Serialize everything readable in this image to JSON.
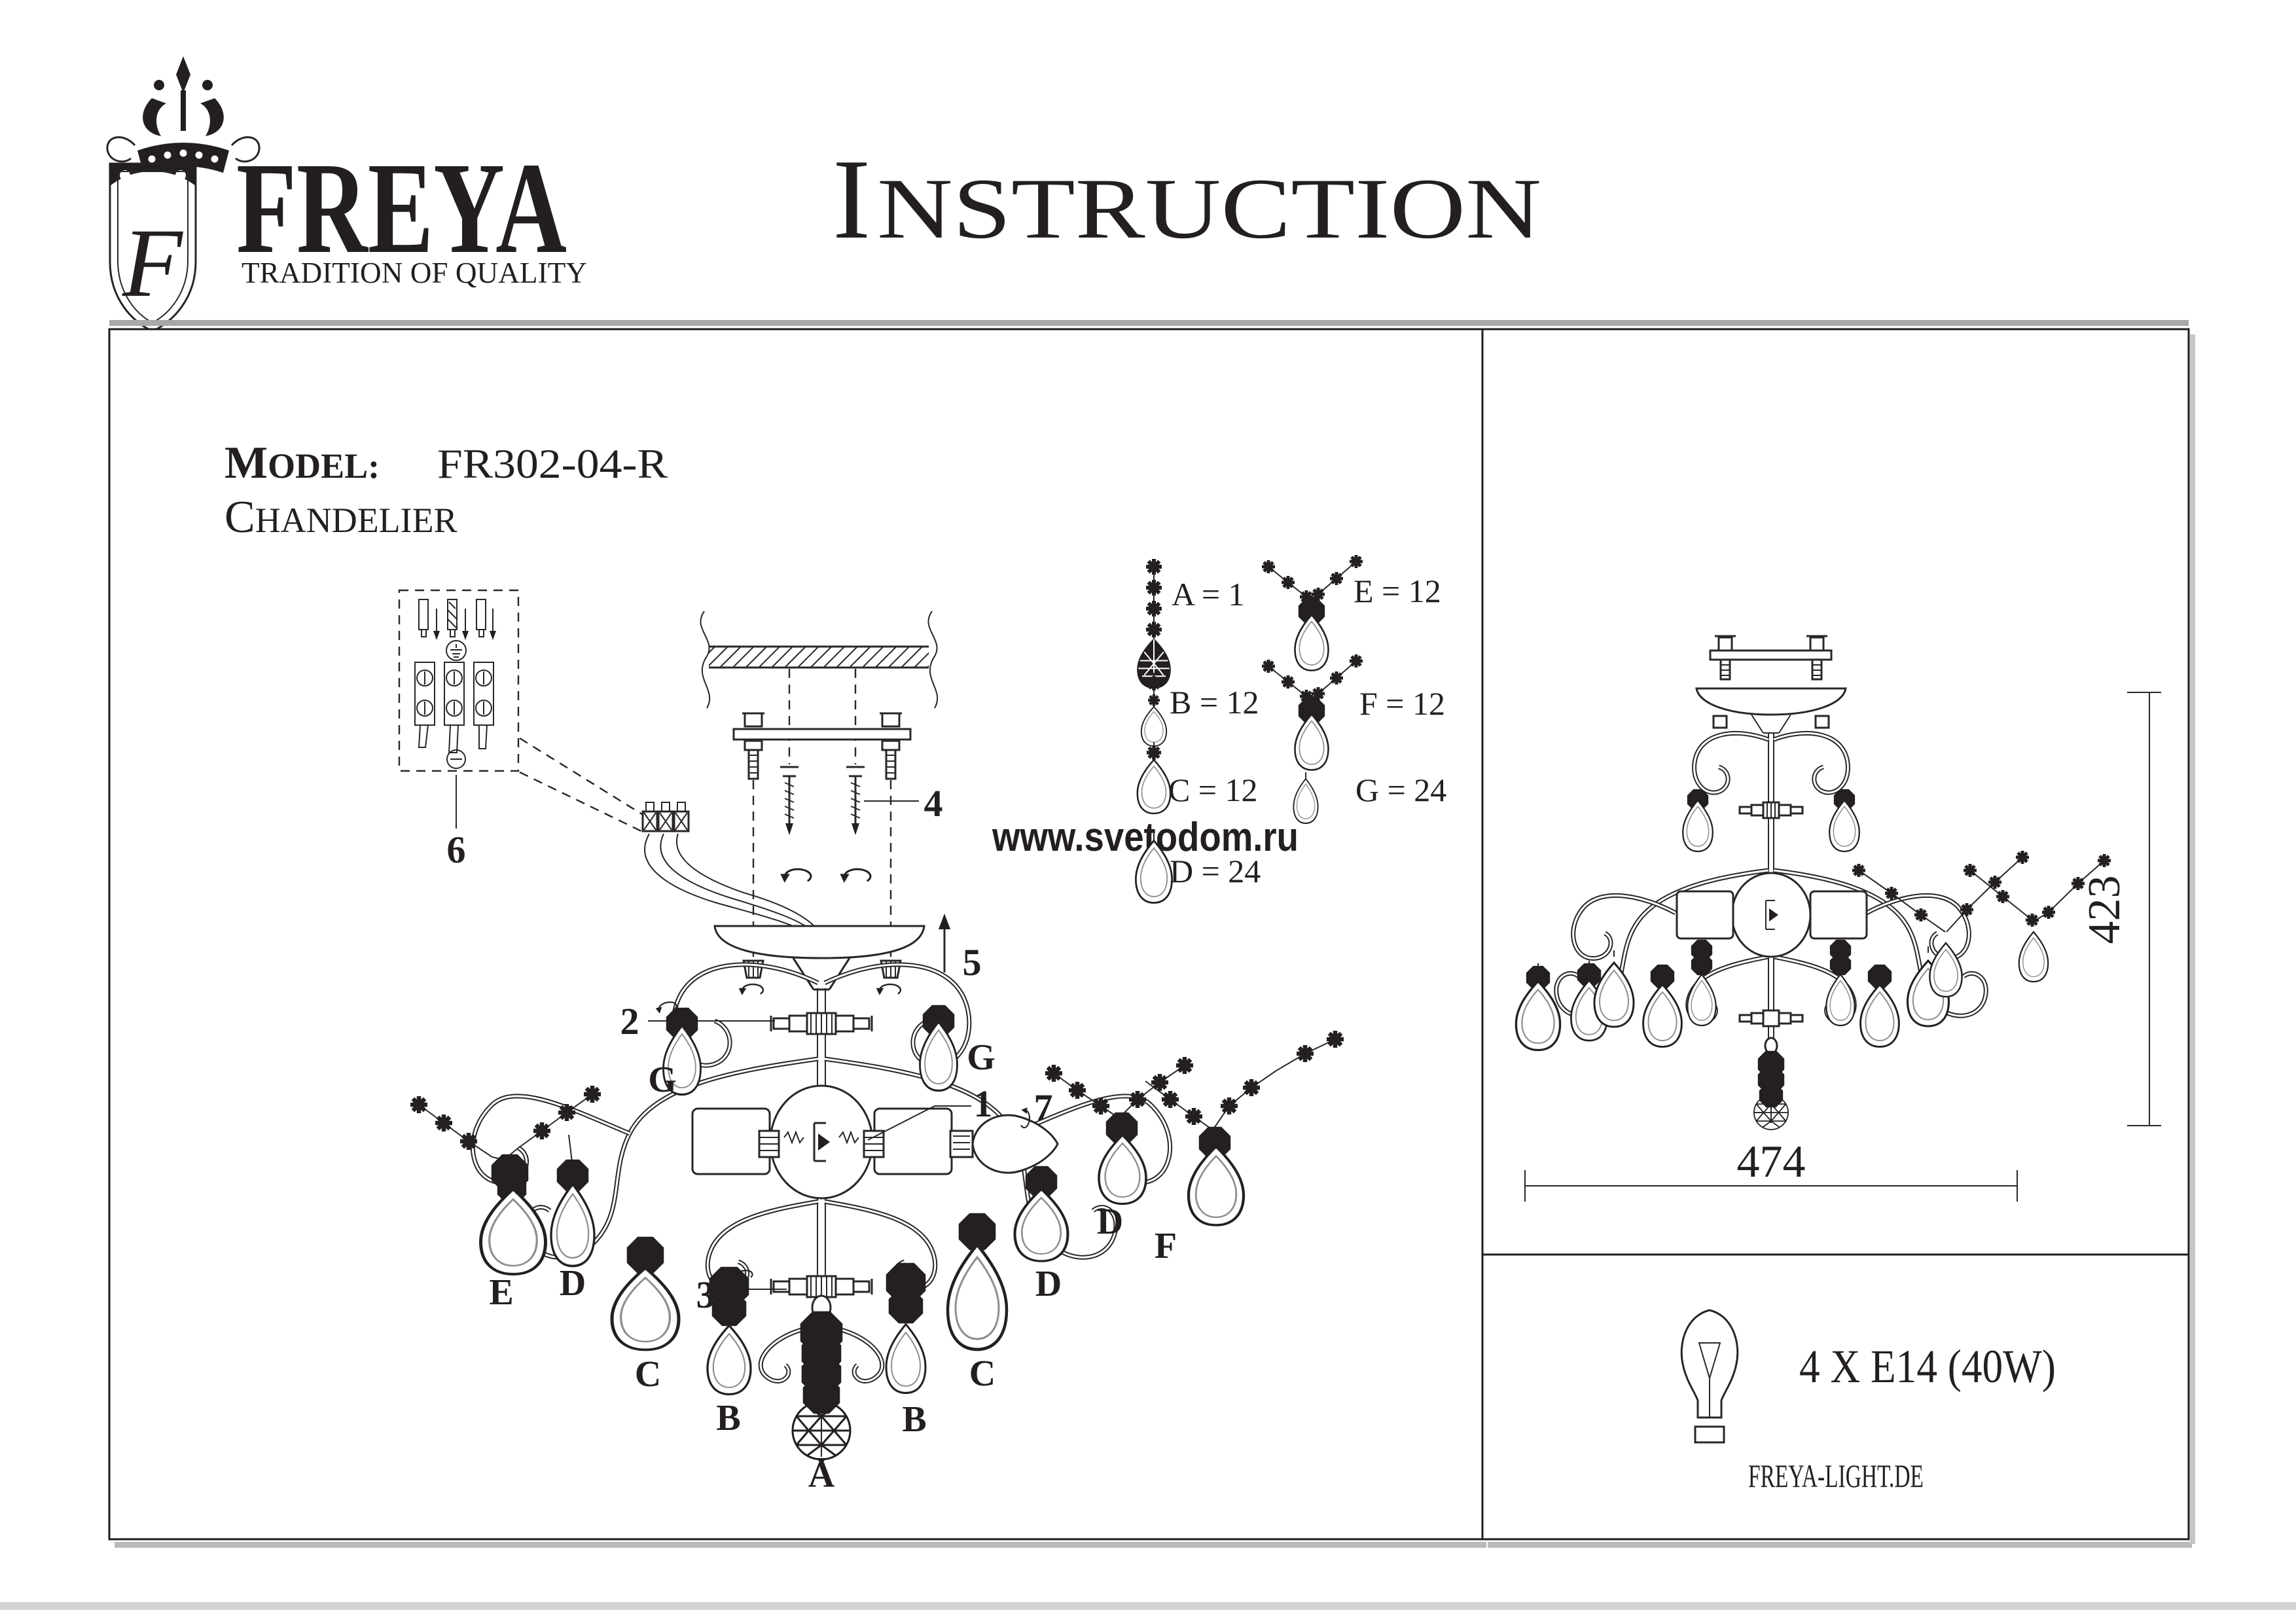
{
  "header": {
    "logo": {
      "monogram": "F",
      "brand": "FREYA",
      "tagline": "TRADITION OF QUALITY"
    },
    "title_initial": "I",
    "title_rest": "NSTRUCTION"
  },
  "model": {
    "label_initial": "M",
    "label_rest": "ODEL:",
    "value": "FR302-04-R",
    "type_initial": "C",
    "type_rest": "HANDELIER"
  },
  "watermark": "www.svetodom.ru",
  "legend": {
    "items": [
      {
        "part": "A",
        "qty": 1,
        "label": "A = 1"
      },
      {
        "part": "B",
        "qty": 12,
        "label": "B = 12"
      },
      {
        "part": "C",
        "qty": 12,
        "label": "C = 12"
      },
      {
        "part": "D",
        "qty": 24,
        "label": "D = 24"
      },
      {
        "part": "E",
        "qty": 12,
        "label": "E = 12"
      },
      {
        "part": "F",
        "qty": 12,
        "label": "F = 12"
      },
      {
        "part": "G",
        "qty": 24,
        "label": "G = 24"
      }
    ]
  },
  "diagram": {
    "callout_1": "1",
    "callout_2": "2",
    "callout_3": "3",
    "callout_4": "4",
    "callout_5": "5",
    "callout_6": "6",
    "callout_7": "7",
    "g_left": "G",
    "g_right": "G",
    "e_label": "E",
    "d_left": "D",
    "c_left": "C",
    "b_left": "B",
    "a_label": "A",
    "b_right": "B",
    "c_right": "C",
    "d_right": "D",
    "d_far": "D",
    "f_label": "F"
  },
  "side_view": {
    "height_mm": "423",
    "width_mm": "474"
  },
  "spec": {
    "bulbs": "4 X E14 (40W)",
    "website": "FREYA-LIGHT.DE"
  }
}
